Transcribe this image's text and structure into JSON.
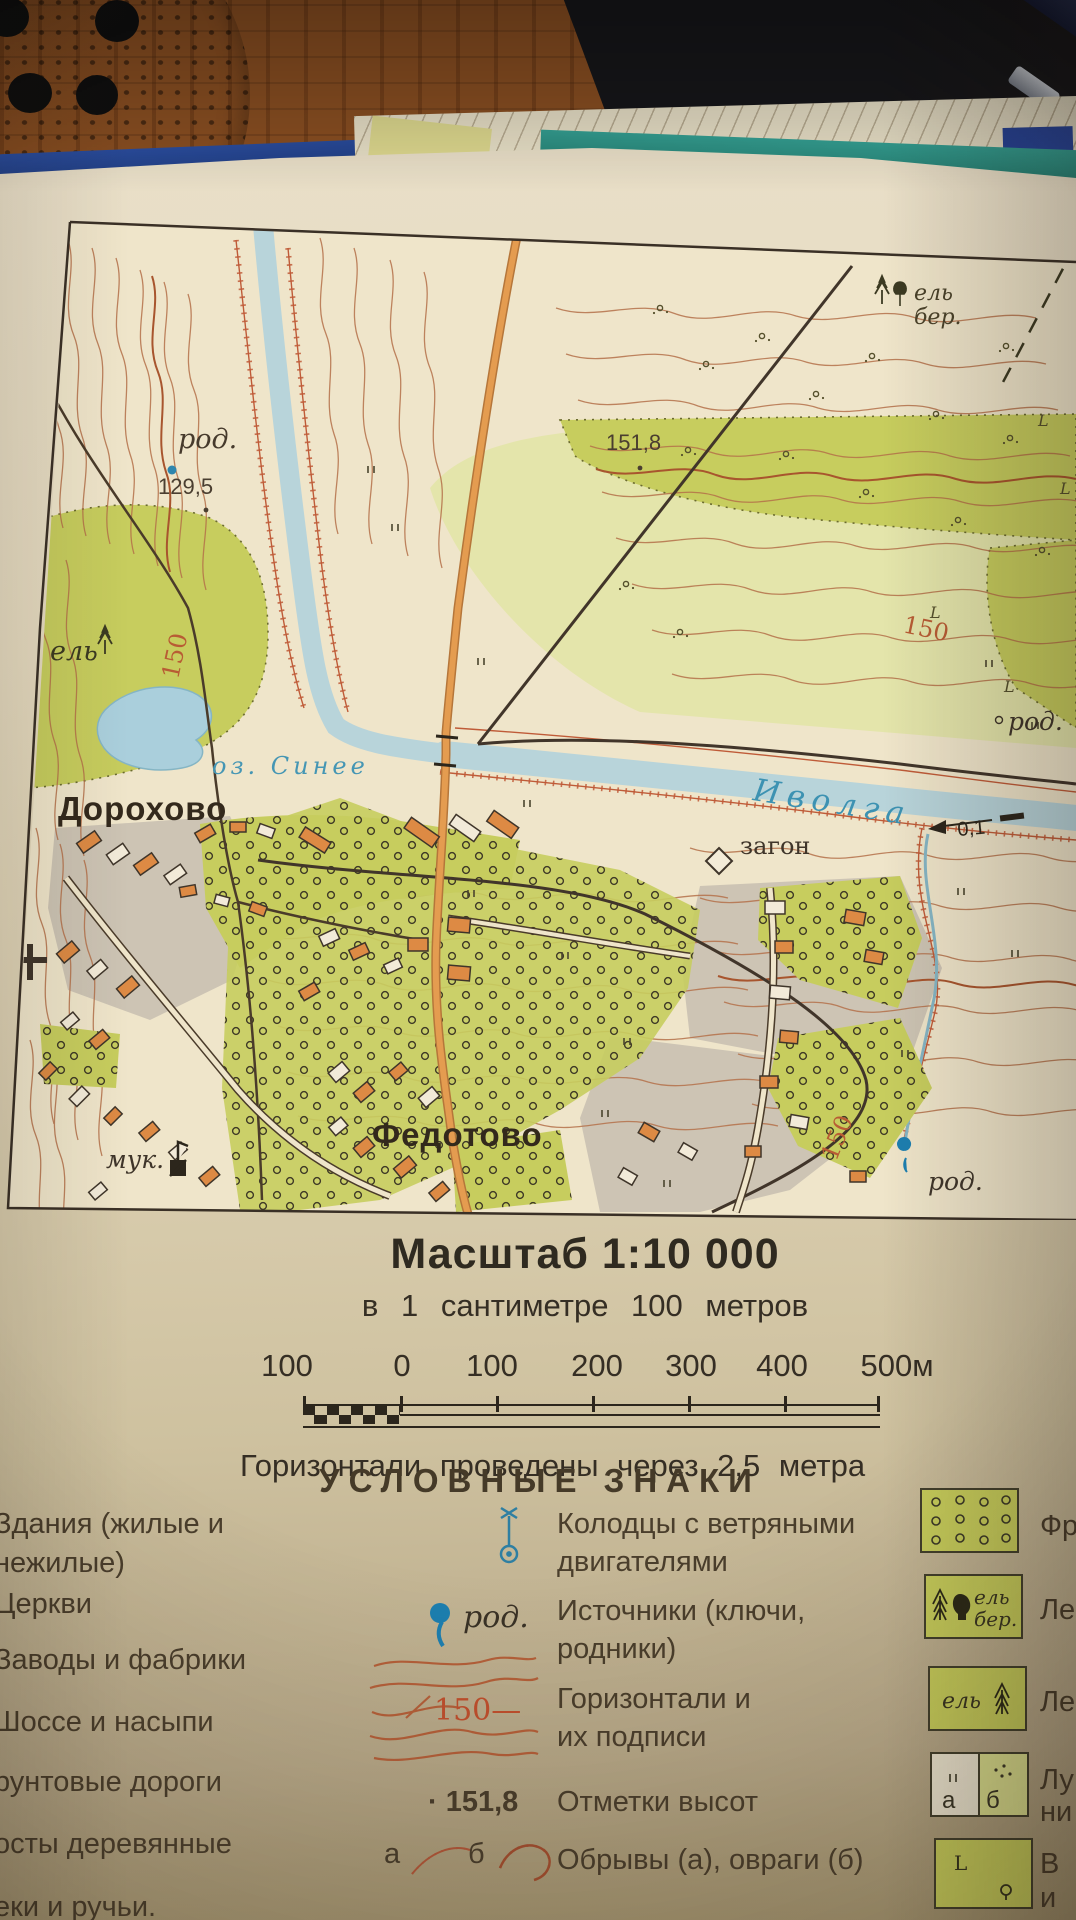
{
  "photo": {
    "desk_items": [
      "perforated-disc",
      "mouse-pad",
      "pen",
      "green-pencil",
      "atlas-book"
    ],
    "sliver_letter": "н"
  },
  "colors": {
    "paper": "#efe5ca",
    "forest_green": "#c7cd5e",
    "forest_pale": "#e4e5ab",
    "water": "#aecdd6",
    "contour": "#b4714a",
    "road_orange": "#e49c50",
    "road_dark": "#41352a",
    "building_orange": "#dd8a44",
    "water_label_blue": "#3d92b2",
    "legend_text": "#4a3e2c"
  },
  "map": {
    "labels": {
      "spot_top": "151,8",
      "spot_left": "129,5",
      "spring_top": "род.",
      "spring_right": "род.",
      "spring_bottom": "род.",
      "forest_left": "ель",
      "forest_tr_1": "ель",
      "forest_tr_2": "бер.",
      "c150_left": "150",
      "c150_right": "150",
      "c150_bottom": "150",
      "lake": "оз. Синее",
      "dorokhovo": "Дорохово",
      "river": "Иволга",
      "flow": "0,1",
      "zagon": "загон",
      "fedotovo": "Федотово",
      "mill": "мук."
    }
  },
  "scale": {
    "title": "Масштаб  1:10 000",
    "subtitle": "в 1 сантиметре 100 метров",
    "bar_labels": [
      "100",
      "0",
      "100",
      "200",
      "300",
      "400",
      "500м"
    ],
    "note": "Горизонтали  проведены  через  2,5 метра"
  },
  "legend": {
    "title": "УСЛОВНЫЕ  ЗНАКИ",
    "left": [
      "Здания (жилые и",
      "нежилые)",
      "Церкви",
      "Заводы и фабрики",
      "Шоссе и насыпи",
      "рунтовые дороги",
      "осты деревянные",
      "еки и ручьи."
    ],
    "m1l1": "Колодцы с ветряными",
    "m1l2": "двигателями",
    "m2l1": "Источники (ключи,",
    "m2l2": "родники)",
    "m2sym": "род.",
    "m3l1": "Горизонтали и",
    "m3l2": "их подписи",
    "m3sym": "150—",
    "m4l1": "Отметки высот",
    "m4sym": "151,8",
    "m4dot": "·",
    "m5l1": "Обрывы (а), овраги (б)",
    "m5a": "а",
    "m5b": "б",
    "r1": "Фр",
    "r2": "Ле",
    "r2sym1": "ель",
    "r2sym2": "бер.",
    "r3": "Ле",
    "r3sym": "ель",
    "r4a": "Лу",
    "r4b": "ни",
    "r4syma": "а",
    "r4symb": "б",
    "r5a": "В",
    "r5b": "и"
  }
}
